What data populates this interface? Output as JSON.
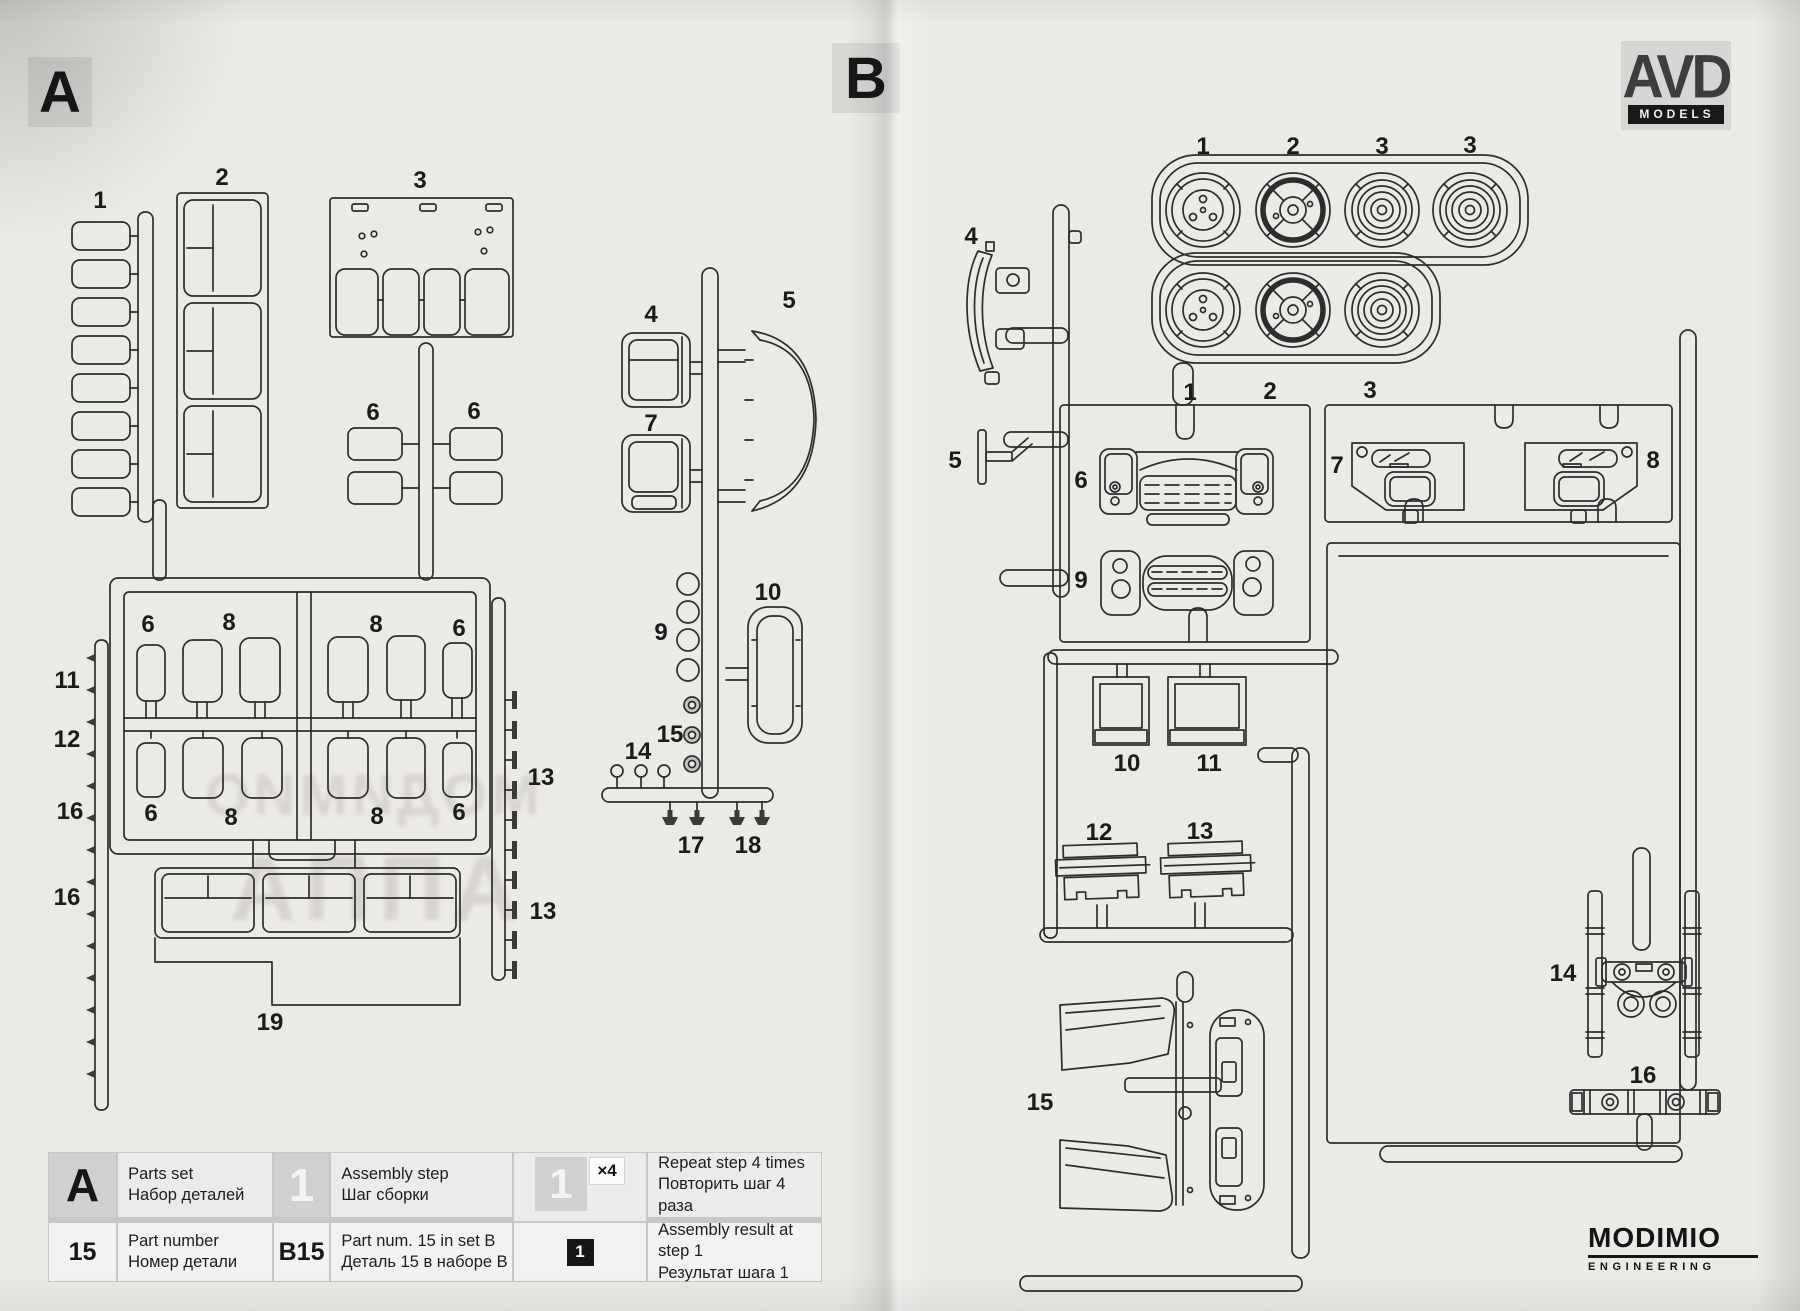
{
  "page": {
    "side_a_label": "A",
    "side_b_label": "B"
  },
  "branding": {
    "avd_line1": "AVD",
    "avd_line2": "MODELS",
    "modimio_name": "MODIMIO",
    "modimio_sub": "ENGINEERING"
  },
  "ghost_text": {
    "line1": "МОДИМИО",
    "line2": "АППА"
  },
  "sprue_a": {
    "part_labels": [
      "1",
      "2",
      "3",
      "6",
      "6",
      "4",
      "7",
      "5",
      "6",
      "8",
      "8",
      "6",
      "11",
      "12",
      "16",
      "16",
      "6",
      "8",
      "8",
      "6",
      "13",
      "13",
      "9",
      "15",
      "14",
      "10",
      "17",
      "18",
      "19"
    ]
  },
  "sprue_b": {
    "part_labels": [
      "1",
      "2",
      "3",
      "3",
      "4",
      "1",
      "2",
      "3",
      "5",
      "6",
      "7",
      "8",
      "9",
      "10",
      "11",
      "12",
      "13",
      "14",
      "15",
      "16"
    ]
  },
  "legend": {
    "rows": [
      {
        "cells": [
          {
            "icon": "A",
            "en": "Parts set",
            "ru": "Набор деталей"
          },
          {
            "icon": "1",
            "en": "Assembly step",
            "ru": "Шаг сборки"
          },
          {
            "icon": "1",
            "badge": "×4",
            "en": "Repeat step 4 times",
            "ru": "Повторить шаг 4 раза"
          }
        ]
      },
      {
        "cells": [
          {
            "icon": "15",
            "en": "Part number",
            "ru": "Номер детали"
          },
          {
            "icon": "B15",
            "en": "Part num. 15 in set B",
            "ru": "Деталь 15 в наборе B"
          },
          {
            "icon": "1",
            "en": "Assembly result at step 1",
            "ru": "Результат шага 1"
          }
        ]
      }
    ]
  }
}
